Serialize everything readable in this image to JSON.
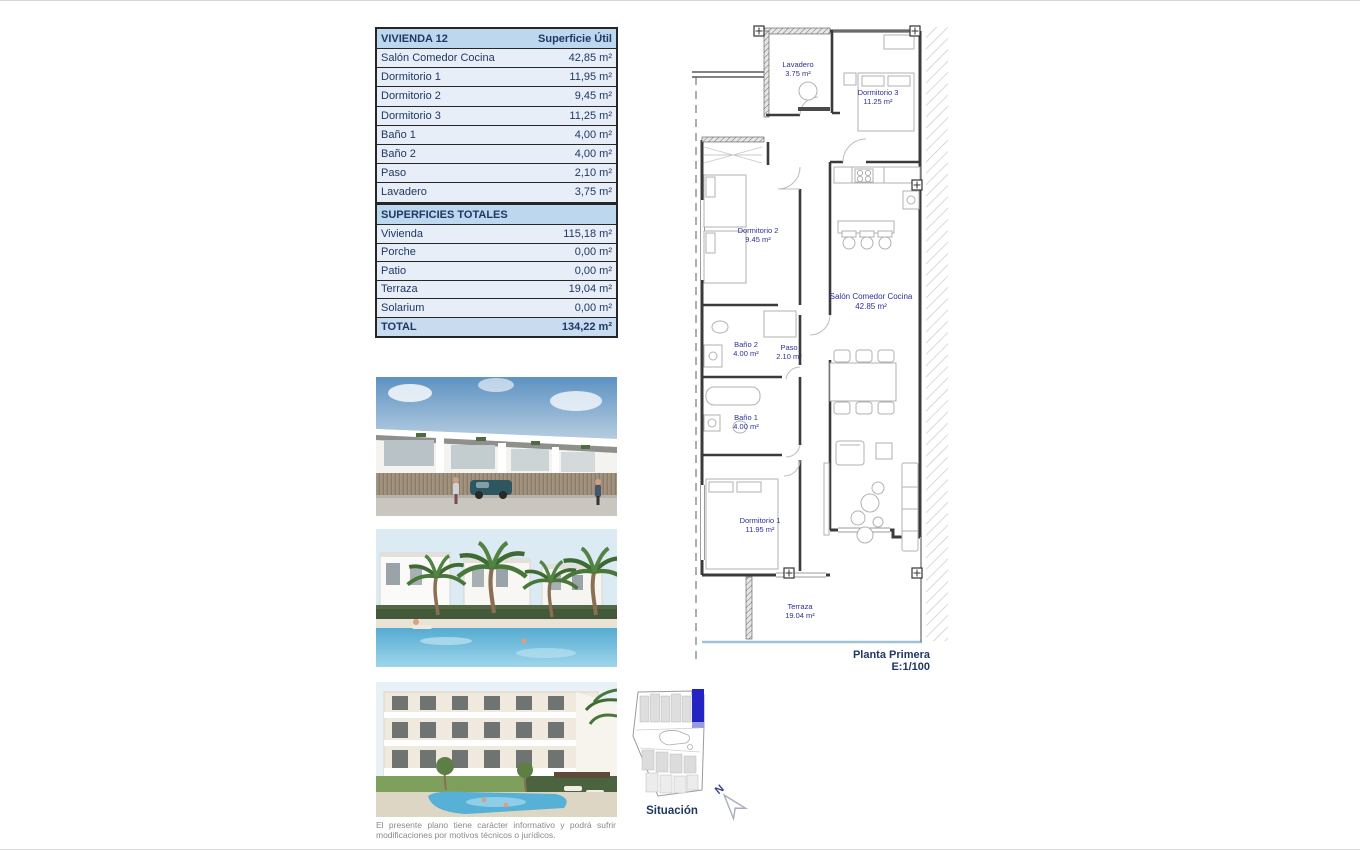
{
  "unit_table": {
    "title": "VIVIENDA 12",
    "header_value": "Superficie Útil",
    "rows": [
      {
        "label": "Salón Comedor Cocina",
        "value": "42,85 m²"
      },
      {
        "label": "Dormitorio 1",
        "value": "11,95 m²"
      },
      {
        "label": "Dormitorio 2",
        "value": "9,45 m²"
      },
      {
        "label": "Dormitorio 3",
        "value": "11,25 m²"
      },
      {
        "label": "Baño 1",
        "value": "4,00 m²"
      },
      {
        "label": "Baño 2",
        "value": "4,00 m²"
      },
      {
        "label": "Paso",
        "value": "2,10 m²"
      },
      {
        "label": "Lavadero",
        "value": "3,75 m²"
      }
    ]
  },
  "totals_table": {
    "title": "SUPERFICIES TOTALES",
    "rows": [
      {
        "label": "Vivienda",
        "value": "115,18 m²"
      },
      {
        "label": "Porche",
        "value": "0,00 m²"
      },
      {
        "label": "Patio",
        "value": "0,00 m²"
      },
      {
        "label": "Terraza",
        "value": "19,04 m²"
      },
      {
        "label": "Solarium",
        "value": "0,00 m²"
      }
    ],
    "total_row": {
      "label": "TOTAL",
      "value": "134,22 m²"
    }
  },
  "floorplan": {
    "rooms": [
      {
        "name": "Lavadero",
        "area": "3.75 m²"
      },
      {
        "name": "Dormitorio 3",
        "area": "11.25 m²"
      },
      {
        "name": "Dormitorio 2",
        "area": "9.45 m²"
      },
      {
        "name": "Salón Comedor Cocina",
        "area": "42.85 m²"
      },
      {
        "name": "Baño 2",
        "area": "4.00 m²"
      },
      {
        "name": "Paso",
        "area": "2.10 m²"
      },
      {
        "name": "Baño 1",
        "area": "4.00 m²"
      },
      {
        "name": "Dormitorio 1",
        "area": "11.95 m²"
      },
      {
        "name": "Terraza",
        "area": "19.04 m²"
      }
    ],
    "caption": {
      "line1": "Planta Primera",
      "line2": "E:1/100"
    }
  },
  "situacion": {
    "label": "Situación",
    "north": "N"
  },
  "disclaimer": {
    "line1": "El presente plano tiene carácter informativo y podrá sufrir",
    "line2": "modificaciones por motivos técnicos o jurídicos."
  },
  "colors": {
    "table_header_bg": "#bdd7ee",
    "table_row_bg": "#e7eef7",
    "table_text": "#1f3864",
    "plan_label": "#2e3192",
    "highlight_plot": "#2424c4",
    "disclaimer_text": "#8a8a8a"
  }
}
